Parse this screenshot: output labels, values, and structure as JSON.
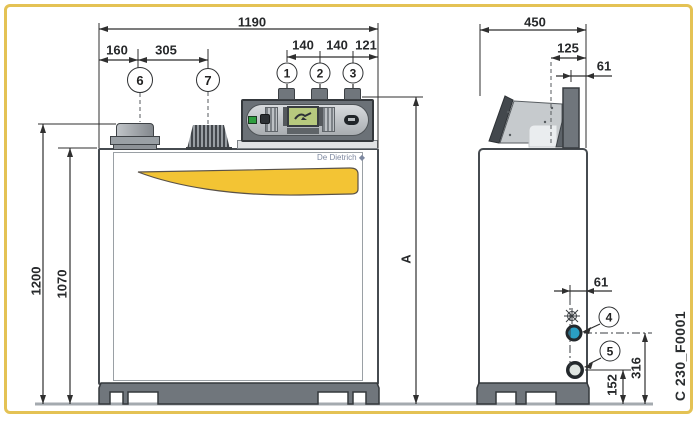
{
  "figure": {
    "brand": "De Dietrich",
    "logo_icon": "◆",
    "code": "C 230_F0001"
  },
  "colors": {
    "frame_yellow": "#e4c254",
    "accent_yellow": "#f3c434",
    "connection_teal": "#2a9fc4",
    "lcd_green": "#b7c97e"
  },
  "front_view": {
    "dims": {
      "total_width": "1190",
      "flue_offset": "160",
      "flue_spacing": "305",
      "tapping_1": "140",
      "tapping_2": "140",
      "tapping_edge": "121",
      "total_height": "1200",
      "body_height": "1070",
      "height_a": "A"
    },
    "callouts": [
      {
        "label": "1"
      },
      {
        "label": "2"
      },
      {
        "label": "3"
      },
      {
        "label": "6"
      },
      {
        "label": "7"
      }
    ]
  },
  "side_view": {
    "dims": {
      "total_depth": "450",
      "flue_depth": "125",
      "flue_edge_offset": "61",
      "connection_edge_offset": "61",
      "connection_height_4": "316",
      "connection_height_5": "152"
    },
    "callouts": [
      {
        "label": "4"
      },
      {
        "label": "5"
      }
    ]
  }
}
